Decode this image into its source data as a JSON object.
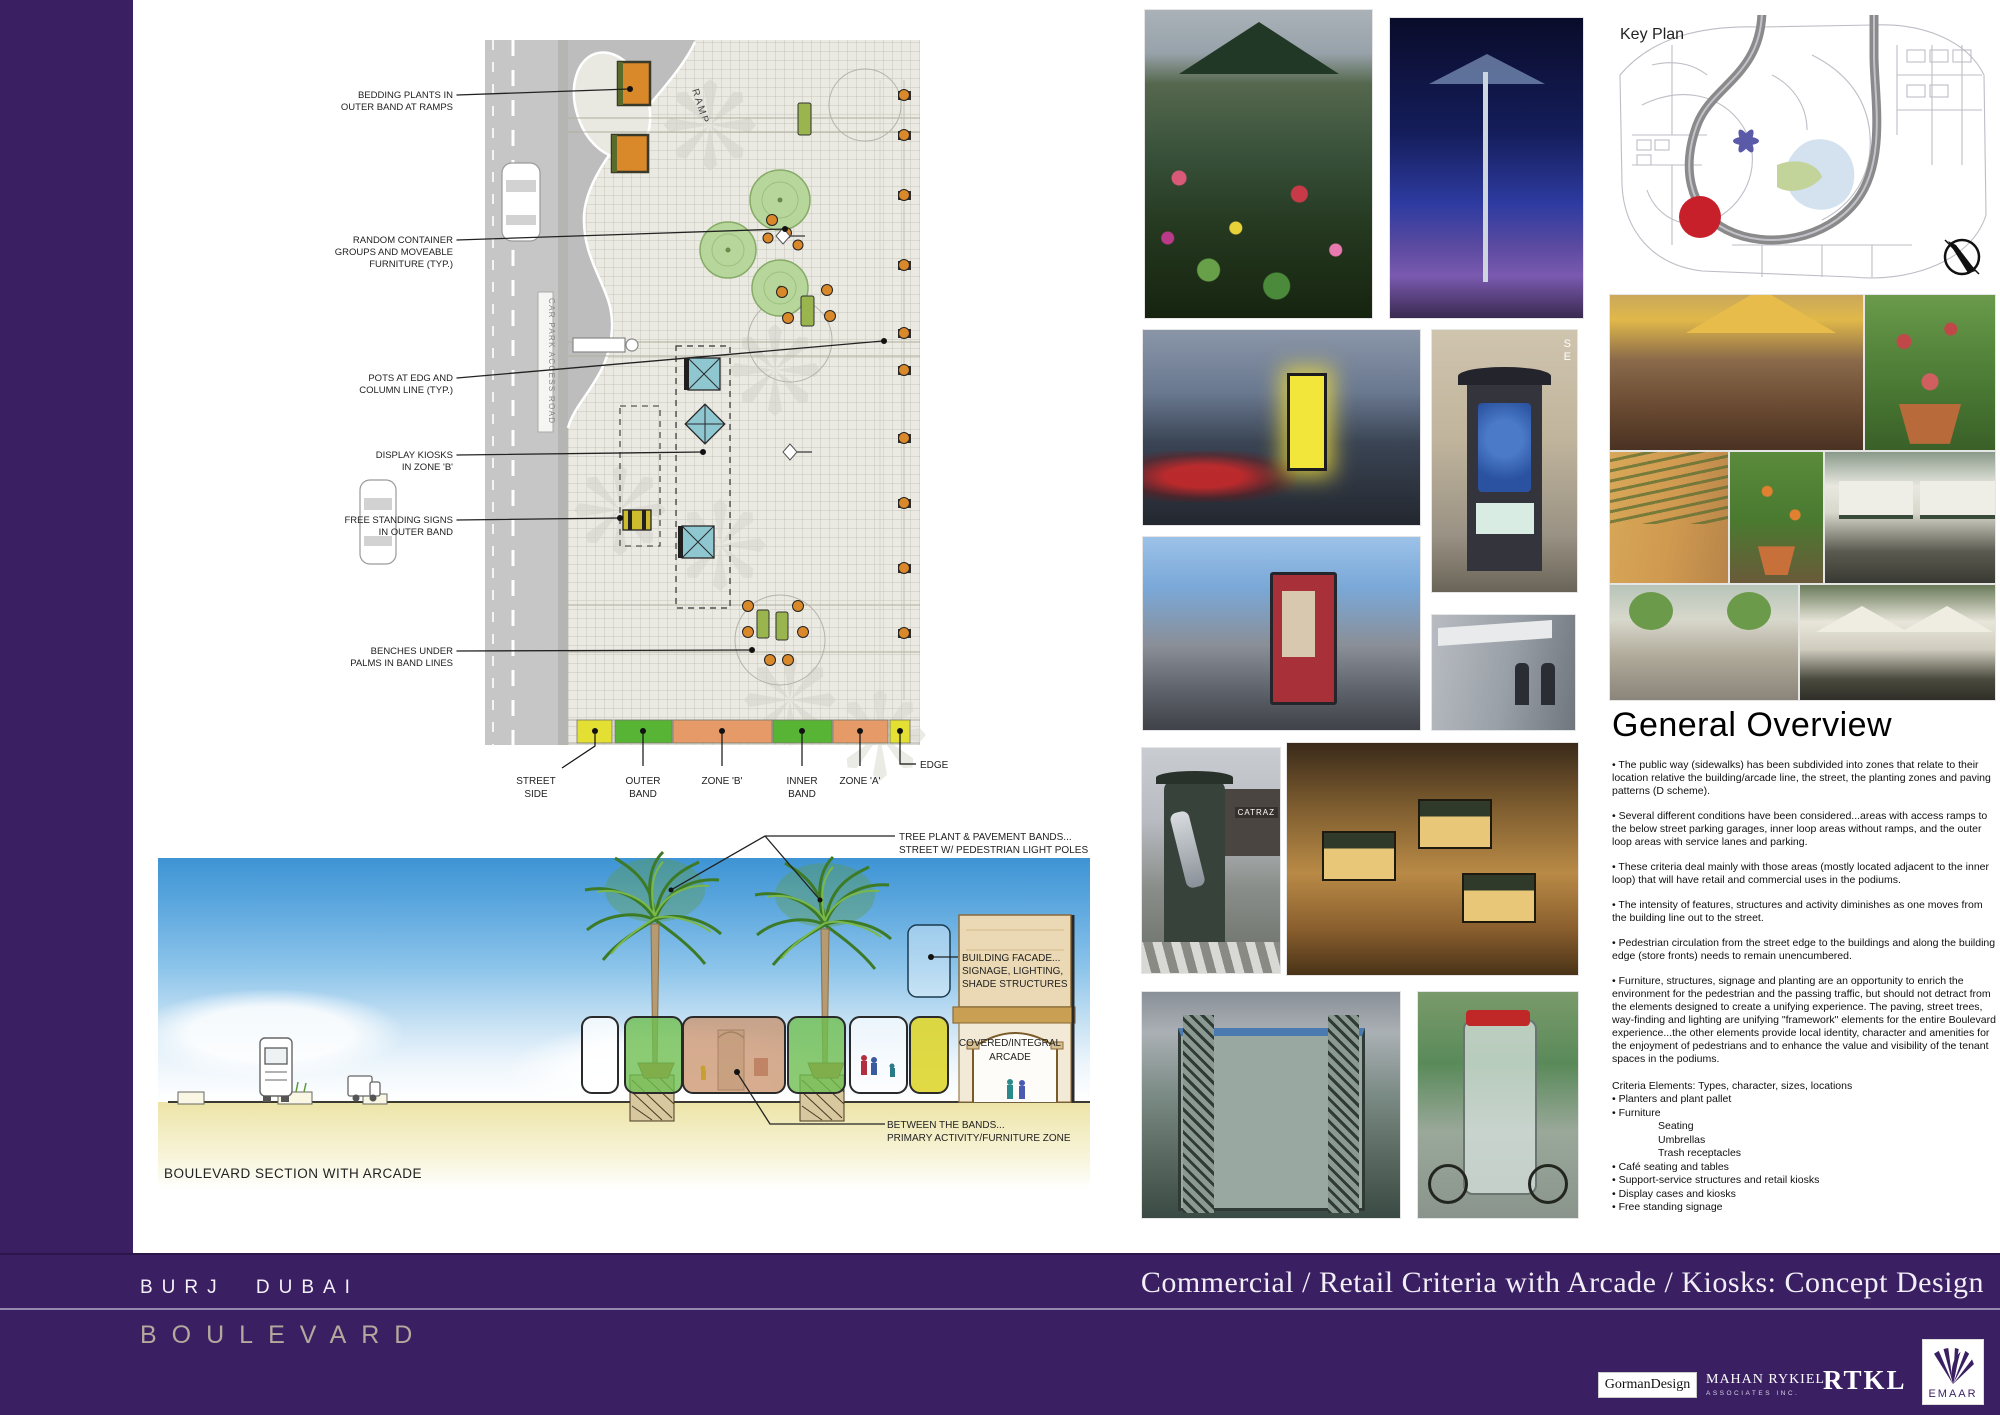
{
  "plan": {
    "ramp_label": "RAMP",
    "access_road_label": "CAR PARK ACCESS ROAD",
    "callouts": [
      {
        "l1": "BEDDING PLANTS IN",
        "l2": "OUTER BAND AT RAMPS"
      },
      {
        "l1": "RANDOM CONTAINER",
        "l2": "GROUPS AND MOVEABLE",
        "l3": "FURNITURE (TYP.)"
      },
      {
        "l1": "POTS AT EDG AND",
        "l2": "COLUMN LINE (TYP.)"
      },
      {
        "l1": "DISPLAY KIOSKS",
        "l2": "IN ZONE 'B'"
      },
      {
        "l1": "FREE STANDING SIGNS",
        "l2": "IN OUTER BAND"
      },
      {
        "l1": "BENCHES UNDER",
        "l2": "PALMS IN BAND LINES"
      }
    ],
    "legend": [
      {
        "l1": "STREET",
        "l2": "SIDE",
        "color": "#e3df33"
      },
      {
        "l1": "OUTER",
        "l2": "BAND",
        "color": "#58b435"
      },
      {
        "l1": "ZONE 'B'",
        "color": "#e59a68"
      },
      {
        "l1": "INNER",
        "l2": "BAND",
        "color": "#58b435"
      },
      {
        "l1": "ZONE 'A'",
        "color": "#e59a68"
      },
      {
        "l1": "EDGE",
        "color": "#e3df33"
      }
    ]
  },
  "section": {
    "title": "BOULEVARD SECTION WITH ARCADE",
    "bands_l1": "TREE PLANT & PAVEMENT BANDS...",
    "bands_l2": "STREET W/ PEDESTRIAN LIGHT POLES",
    "facade_l1": "BUILDING FACADE...",
    "facade_l2": "SIGNAGE, LIGHTING,",
    "facade_l3": "SHADE STRUCTURES",
    "arcade_l1": "COVERED/INTEGRAL",
    "arcade_l2": "ARCADE",
    "between_l1": "BETWEEN THE BANDS...",
    "between_l2": "PRIMARY ACTIVITY/FURNITURE ZONE"
  },
  "key_plan": {
    "title": "Key Plan"
  },
  "photos": {
    "catraz_sign": "CATRAZ",
    "se_top": "S",
    "se_bottom": "E"
  },
  "overview": {
    "heading": "General Overview",
    "paragraphs": [
      "• The public way (sidewalks) has  been  subdivided into zones that relate to their location relative the building/arcade line, the street, the planting zones and paving patterns (D scheme).",
      "• Several different conditions have been considered...areas with access ramps to the below street parking garages, inner loop areas without ramps, and the outer loop areas with service lanes and parking.",
      "• These criteria deal mainly with those areas (mostly located adjacent to the inner loop) that will have retail and commercial uses in the podiums.",
      "• The intensity of features, structures and activity diminishes as one moves from the building line out to the street.",
      "• Pedestrian circulation from the street edge to the buildings and along the building edge (store fronts) needs to remain unencumbered.",
      "• Furniture, structures, signage and planting are an opportunity to enrich the environment for the pedestrian and the passing traffic, but should not detract from the elements designed to create a unifying experience.  The paving, street trees, way-finding and lighting are unifying \"framework\" elements for the entire Boulevard experience...the  other elements provide local identity, character and amenities for the enjoyment of pedestrians and to enhance the value and visibility of the tenant spaces in the podiums."
    ],
    "criteria_heading": "Criteria Elements:  Types, character, sizes, locations",
    "criteria": [
      "• Planters and plant pallet",
      "• Furniture",
      "Seating",
      "Umbrellas",
      "Trash receptacles",
      "• Café seating and tables",
      "• Support-service structures and retail kiosks",
      "• Display cases and kiosks",
      "• Free standing signage"
    ]
  },
  "footer": {
    "project_name": "BURJ DUBAI",
    "project_sub": "BOULEVARD",
    "sheet_title": "Commercial / Retail Criteria with Arcade / Kiosks: Concept Design",
    "logo_gorman": "GormanDesign",
    "logo_mahan_l1": "MAHAN RYKIEL",
    "logo_mahan_l2": "ASSOCIATES INC.",
    "logo_rtkl": "RTKL",
    "logo_emaar": "EMAAR"
  }
}
